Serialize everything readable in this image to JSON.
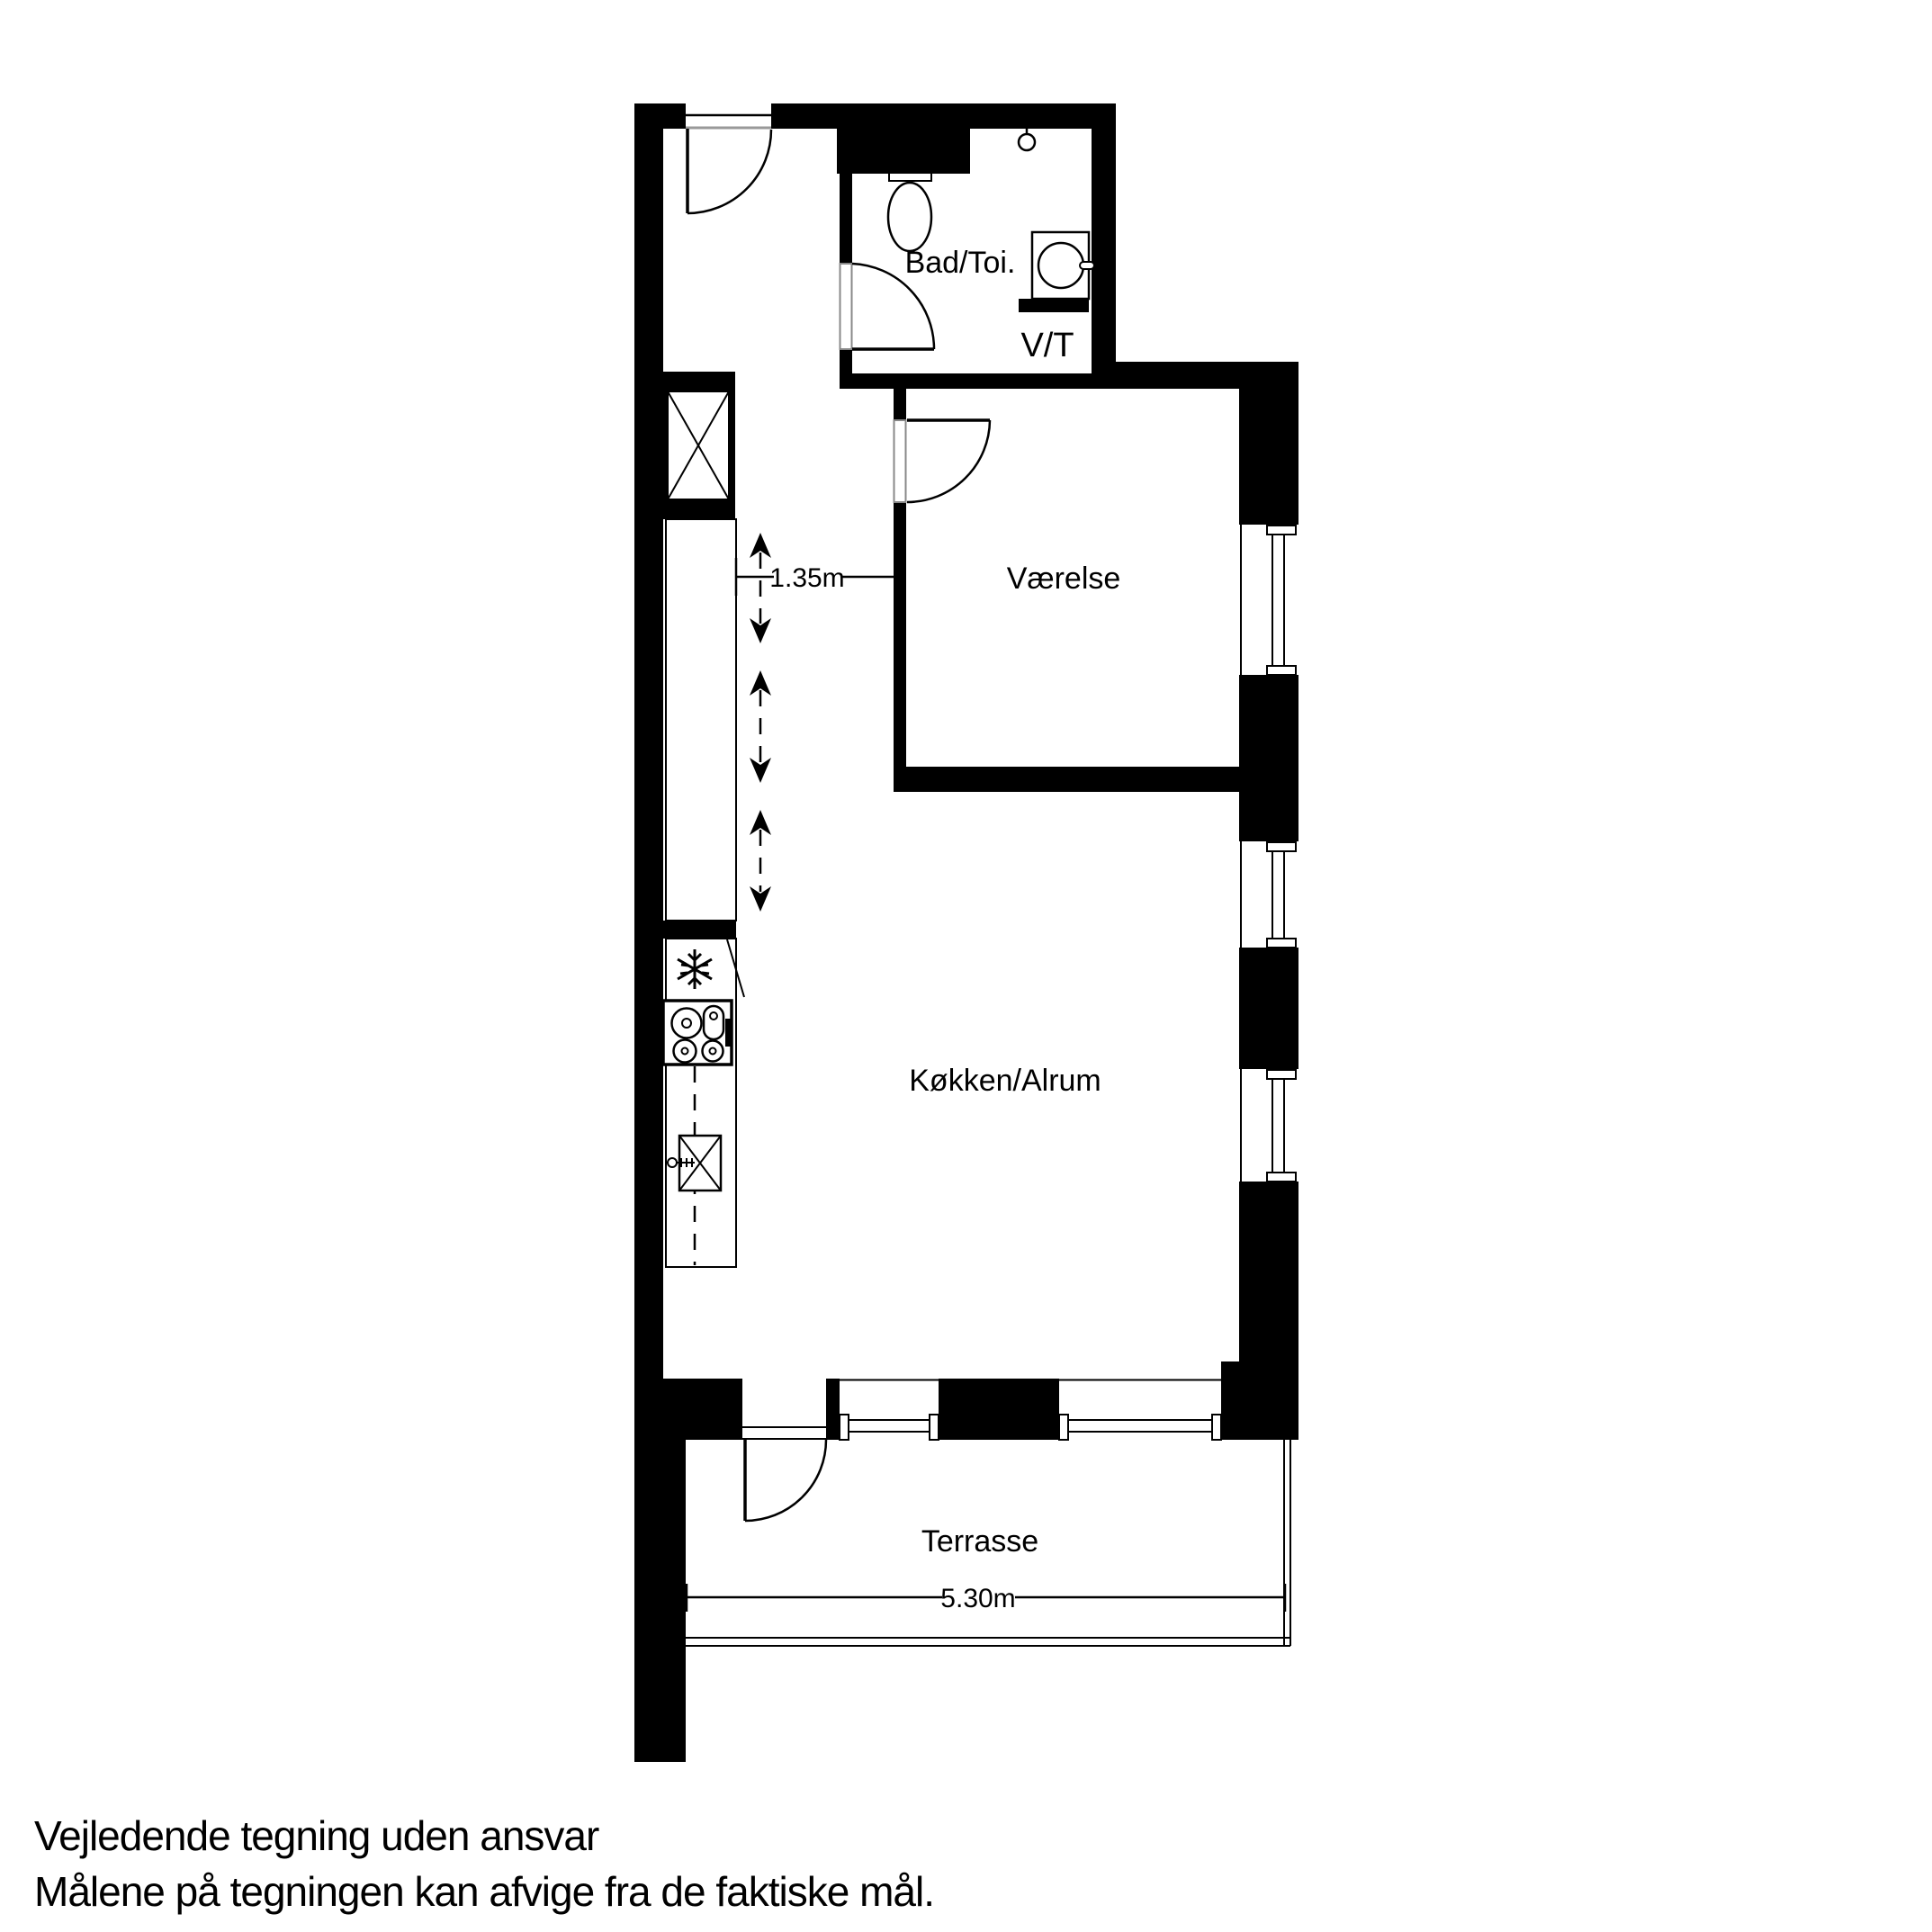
{
  "floorplan": {
    "colors": {
      "wall": "#000000",
      "background": "#ffffff",
      "line": "#000000"
    },
    "rooms": {
      "bathroom": {
        "label": "Bad/Toi."
      },
      "utility": {
        "label": "V/T"
      },
      "bedroom": {
        "label": "Værelse"
      },
      "kitchen": {
        "label": "Køkken/Alrum"
      },
      "terrace": {
        "label": "Terrasse"
      }
    },
    "dimensions": {
      "hall_width": {
        "label": "1.35m"
      },
      "terrace_width": {
        "label": "5.30m"
      }
    },
    "fixtures": {
      "toilet": "toilet",
      "washing_machine": "washing-machine",
      "shower": "shower",
      "fridge": "refrigerator",
      "stove": "stove",
      "kitchen_sink": "kitchen-sink",
      "shaft": "ventilation-shaft"
    },
    "footer": {
      "line1": "Vejledende tegning uden ansvar",
      "line2": "Målene på tegningen kan afvige fra de faktiske mål."
    }
  }
}
